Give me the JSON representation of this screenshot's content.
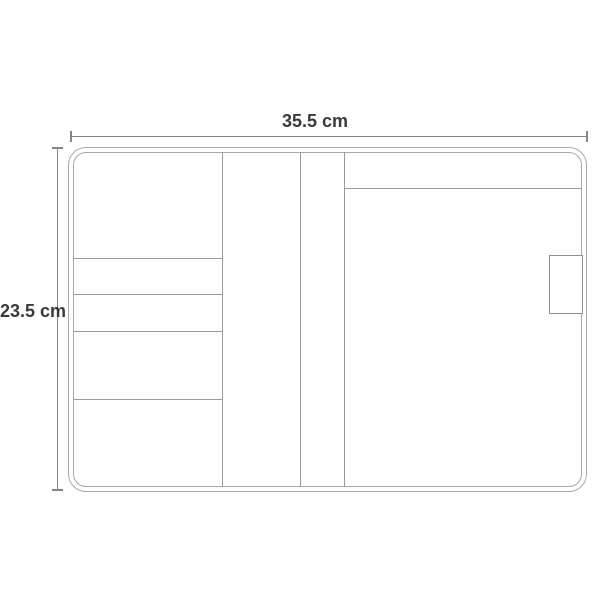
{
  "diagram": {
    "width_dimension": {
      "label": "35.5 cm"
    },
    "height_dimension": {
      "label": "23.5 cm"
    },
    "colors": {
      "background": "#ffffff",
      "outline_line": "#a9a9a9",
      "detail_line": "#9a9a9a",
      "dimension_line": "#858585",
      "label_text": "#3a3a3a"
    }
  }
}
